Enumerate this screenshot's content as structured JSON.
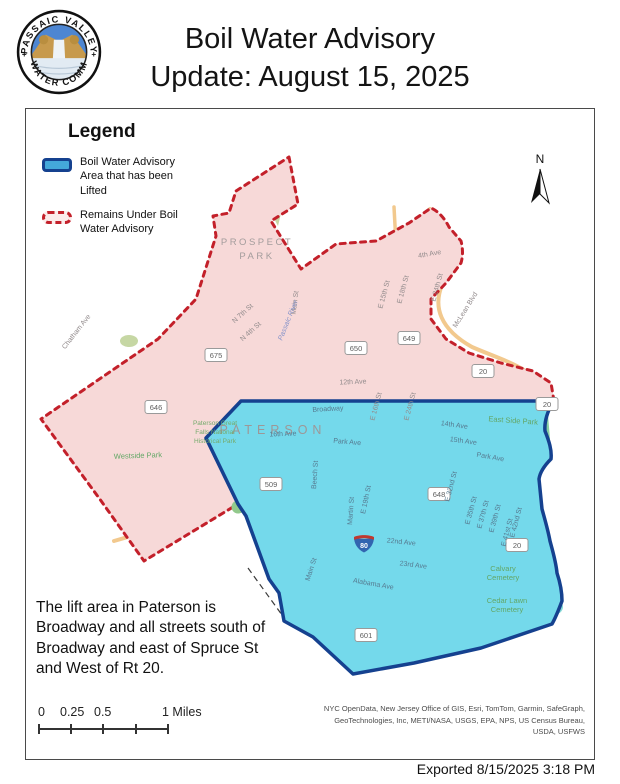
{
  "header": {
    "title_line1": "Boil Water Advisory",
    "title_line2": "Update: August 15, 2025",
    "logo_top": "PASSAIC VALLEY",
    "logo_bottom": "WATER COMM",
    "logo_left_symbol": "+",
    "logo_right_symbol": "+"
  },
  "legend": {
    "title": "Legend",
    "items": [
      {
        "label": "Boil Water Advisory Area that has been Lifted"
      },
      {
        "label": "Remains Under Boil Water Advisory"
      }
    ]
  },
  "map": {
    "north_label": "N",
    "interstate_number": "80",
    "colors": {
      "lifted_fill": "#74d9eb",
      "lifted_border": "#15418f",
      "advisory_fill": "#f7d9d8",
      "advisory_border": "#c3202a",
      "park_green": "#9ccf93",
      "road_orange": "#f2c98e",
      "interstate_blue": "#3265b0",
      "interstate_red": "#c0392f"
    },
    "labels": [
      {
        "t": "PROSPECT",
        "x": 231,
        "y": 136,
        "r": 0,
        "c": "city"
      },
      {
        "t": "PARK",
        "x": 231,
        "y": 150,
        "r": 0,
        "c": "city"
      },
      {
        "t": "PATERSON",
        "x": 247,
        "y": 325,
        "r": 0,
        "c": "cityBig"
      },
      {
        "t": "4th Ave",
        "x": 404,
        "y": 147,
        "r": -10,
        "c": "st"
      },
      {
        "t": "E 15th St",
        "x": 360,
        "y": 186,
        "r": -75,
        "c": "st"
      },
      {
        "t": "E 18th St",
        "x": 379,
        "y": 181,
        "r": -75,
        "c": "st"
      },
      {
        "t": "E 24th St",
        "x": 413,
        "y": 179,
        "r": -75,
        "c": "st"
      },
      {
        "t": "McLean Blvd",
        "x": 441,
        "y": 202,
        "r": -58,
        "c": "st"
      },
      {
        "t": "N 7th St",
        "x": 218,
        "y": 206,
        "r": -42,
        "c": "st"
      },
      {
        "t": "N 4th St",
        "x": 226,
        "y": 224,
        "r": -42,
        "c": "st"
      },
      {
        "t": "Main St",
        "x": 271,
        "y": 194,
        "r": -83,
        "c": "st"
      },
      {
        "t": "Passaic River",
        "x": 264,
        "y": 212,
        "r": -68,
        "c": "river"
      },
      {
        "t": "Chatham Ave",
        "x": 52,
        "y": 224,
        "r": -52,
        "c": "st"
      },
      {
        "t": "12th Ave",
        "x": 327,
        "y": 275,
        "r": -2,
        "c": "st"
      },
      {
        "t": "Westside Park",
        "x": 112,
        "y": 349,
        "r": -2,
        "c": "park"
      },
      {
        "t": "Paterson Great",
        "x": 189,
        "y": 316,
        "r": 0,
        "c": "parkSm"
      },
      {
        "t": "Falls National",
        "x": 189,
        "y": 325,
        "r": 0,
        "c": "parkSm"
      },
      {
        "t": "Historical Park",
        "x": 189,
        "y": 334,
        "r": 0,
        "c": "parkSm"
      },
      {
        "t": "E 16th St",
        "x": 352,
        "y": 298,
        "r": -75,
        "c": "st"
      },
      {
        "t": "E 24th St",
        "x": 386,
        "y": 298,
        "r": -75,
        "c": "st"
      },
      {
        "t": "Broadway",
        "x": 302,
        "y": 302,
        "r": -3,
        "c": "stB"
      },
      {
        "t": "16th Ave",
        "x": 257,
        "y": 327,
        "r": -2,
        "c": "stB"
      },
      {
        "t": "Park Ave",
        "x": 321,
        "y": 335,
        "r": 5,
        "c": "stB"
      },
      {
        "t": "14th Ave",
        "x": 428,
        "y": 318,
        "r": 8,
        "c": "stB"
      },
      {
        "t": "15th Ave",
        "x": 437,
        "y": 334,
        "r": 8,
        "c": "stB"
      },
      {
        "t": "East Side Park",
        "x": 487,
        "y": 314,
        "r": 4,
        "c": "park"
      },
      {
        "t": "Park Ave",
        "x": 464,
        "y": 350,
        "r": 10,
        "c": "stB"
      },
      {
        "t": "Beech St",
        "x": 291,
        "y": 366,
        "r": -86,
        "c": "stB"
      },
      {
        "t": "Martin St",
        "x": 327,
        "y": 402,
        "r": -86,
        "c": "stB"
      },
      {
        "t": "E 19th St",
        "x": 342,
        "y": 391,
        "r": -78,
        "c": "stB"
      },
      {
        "t": "E 32nd St",
        "x": 427,
        "y": 378,
        "r": -75,
        "c": "stB"
      },
      {
        "t": "E 35th St",
        "x": 447,
        "y": 402,
        "r": -75,
        "c": "stB"
      },
      {
        "t": "E 37th St",
        "x": 459,
        "y": 406,
        "r": -75,
        "c": "stB"
      },
      {
        "t": "E 39th St",
        "x": 471,
        "y": 410,
        "r": -75,
        "c": "stB"
      },
      {
        "t": "E 41st St",
        "x": 483,
        "y": 424,
        "r": -75,
        "c": "stB"
      },
      {
        "t": "E 42nd St",
        "x": 492,
        "y": 414,
        "r": -75,
        "c": "stB"
      },
      {
        "t": "22nd Ave",
        "x": 375,
        "y": 435,
        "r": 6,
        "c": "stB"
      },
      {
        "t": "23rd Ave",
        "x": 387,
        "y": 458,
        "r": 7,
        "c": "stB"
      },
      {
        "t": "Alabama Ave",
        "x": 347,
        "y": 477,
        "r": 10,
        "c": "stB"
      },
      {
        "t": "Main St",
        "x": 287,
        "y": 461,
        "r": -72,
        "c": "stB"
      },
      {
        "t": "Calvary",
        "x": 477,
        "y": 462,
        "r": 0,
        "c": "park"
      },
      {
        "t": "Cemetery",
        "x": 477,
        "y": 471,
        "r": 0,
        "c": "park"
      },
      {
        "t": "Cedar Lawn",
        "x": 481,
        "y": 494,
        "r": 0,
        "c": "park"
      },
      {
        "t": "Cemetery",
        "x": 481,
        "y": 503,
        "r": 0,
        "c": "park"
      }
    ],
    "shields": [
      {
        "t": "675",
        "x": 190,
        "y": 246
      },
      {
        "t": "646",
        "x": 130,
        "y": 298
      },
      {
        "t": "650",
        "x": 330,
        "y": 239
      },
      {
        "t": "649",
        "x": 383,
        "y": 229
      },
      {
        "t": "20",
        "x": 457,
        "y": 262
      },
      {
        "t": "20",
        "x": 521,
        "y": 295
      },
      {
        "t": "509",
        "x": 245,
        "y": 375
      },
      {
        "t": "648",
        "x": 413,
        "y": 385
      },
      {
        "t": "601",
        "x": 340,
        "y": 526
      },
      {
        "t": "20",
        "x": 491,
        "y": 436
      }
    ]
  },
  "note": {
    "lines": [
      "The lift area in Paterson is",
      "Broadway and all streets south of",
      "Broadway and east of Spruce St",
      "and West of Rt 20."
    ]
  },
  "scale_bar": {
    "t0": "0",
    "t1": "0.25",
    "t2": "0.5",
    "t3": "1 Miles"
  },
  "attribution": {
    "line1": "NYC OpenData, New Jersey Office of GIS, Esri, TomTom, Garmin, SafeGraph,",
    "line2": "GeoTechnologies, Inc, METI/NASA, USGS, EPA, NPS, US Census Bureau,",
    "line3": "USDA, USFWS"
  },
  "footer": {
    "exported": "Exported 8/15/2025 3:18 PM"
  }
}
